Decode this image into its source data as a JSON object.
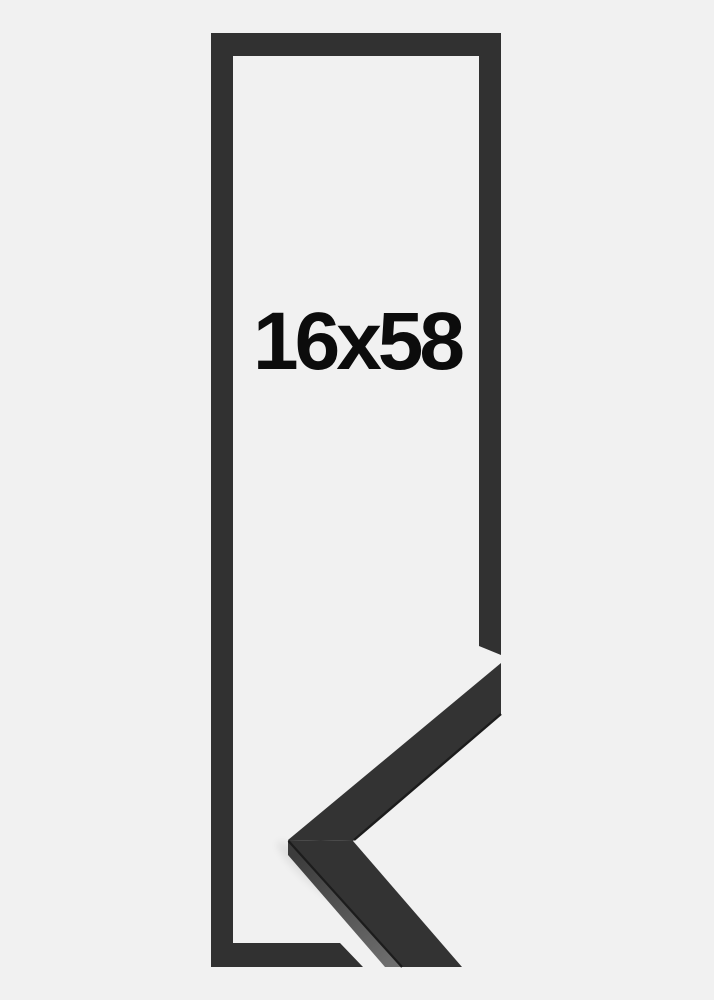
{
  "page": {
    "background": "#f1f1f1"
  },
  "label": {
    "text": "16x58",
    "color": "#0c0c0c"
  },
  "frame_graphic": {
    "description": "black picture frame outline",
    "color": "#313131"
  },
  "corner_sample": {
    "description": "black frame moulding corner sample",
    "front_color": "#333333",
    "edge_dark": "#1c1c1c",
    "side_top": "#3c3c3c",
    "side_bottom": "#6f6f6f",
    "shadow": "#000000"
  }
}
